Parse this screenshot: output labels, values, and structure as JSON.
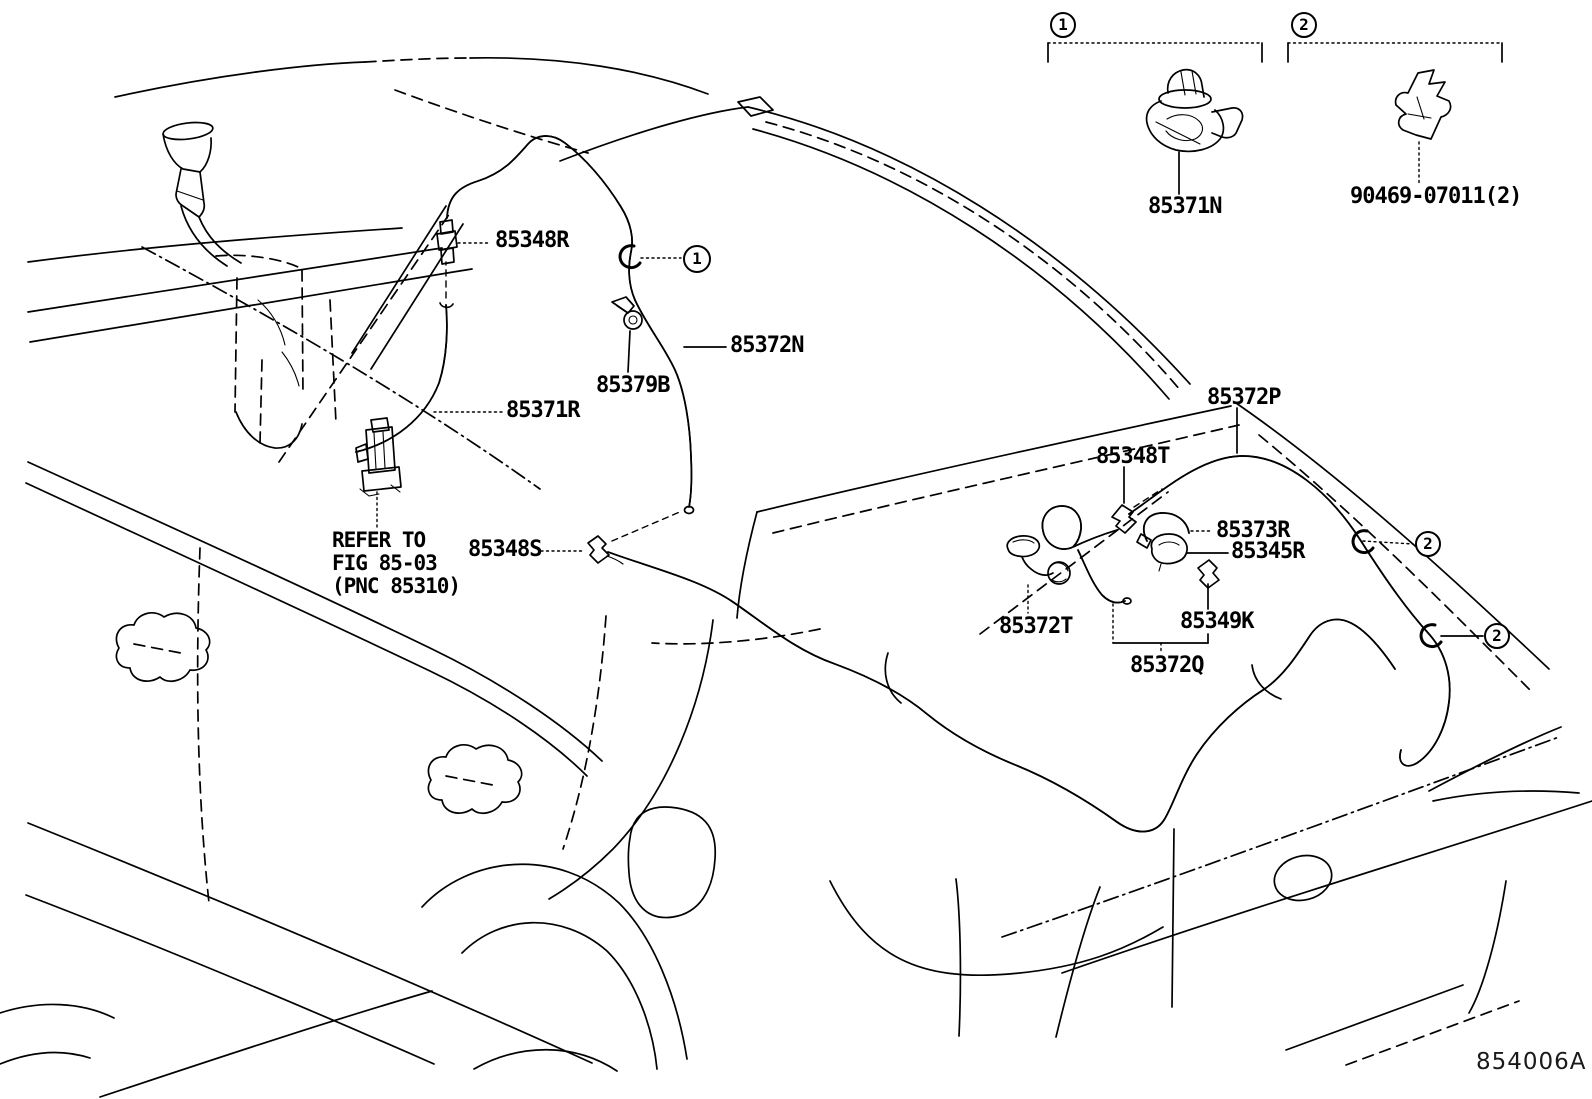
{
  "figure": {
    "code": "854006A"
  },
  "note": {
    "line1": "REFER TO",
    "line2": "FIG 85-03",
    "line3": "(PNC 85310)"
  },
  "labels": {
    "l85348R": "85348R",
    "l85372N": "85372N",
    "l85379B": "85379B",
    "l85371R": "85371R",
    "l85348S": "85348S",
    "l85371N": "85371N",
    "l90469": "90469-07011(2)",
    "l85372P": "85372P",
    "l85348T": "85348T",
    "l85373R": "85373R",
    "l85345R": "85345R",
    "l85372T": "85372T",
    "l85349K": "85349K",
    "l85372Q": "85372Q"
  },
  "callouts": {
    "inset1": "1",
    "inset2": "2",
    "main1": "1",
    "main2a": "2",
    "main2b": "2"
  },
  "colors": {
    "line": "#000000",
    "background": "#ffffff"
  }
}
